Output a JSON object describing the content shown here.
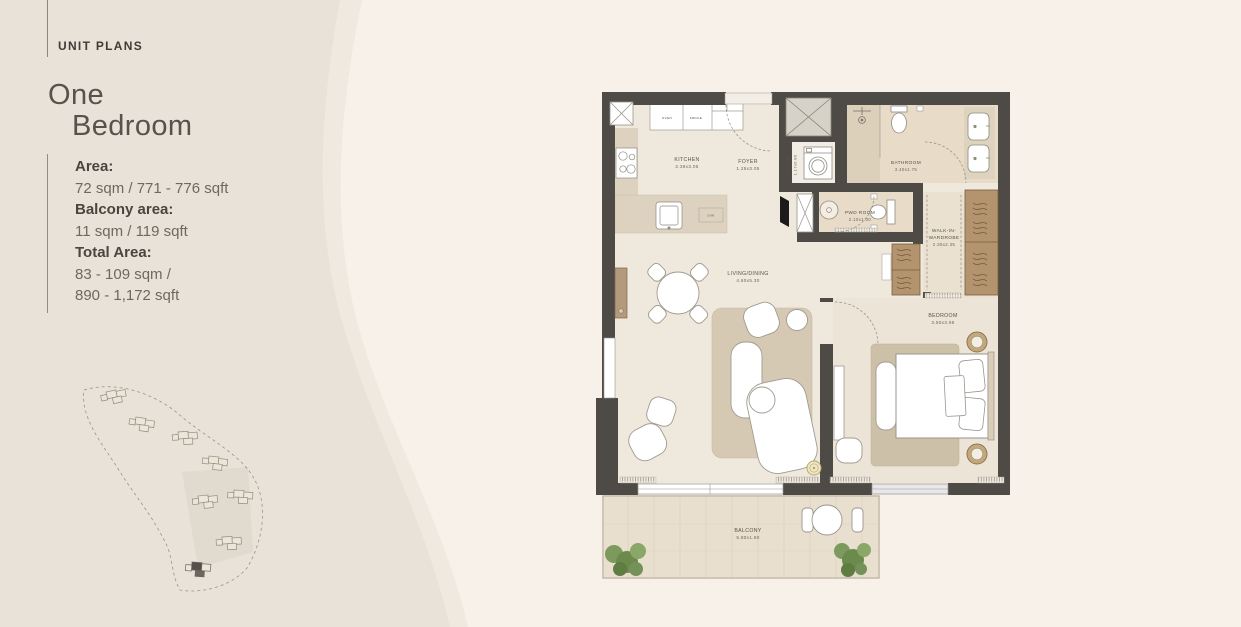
{
  "page": {
    "colors": {
      "background_left": "#e9e2d9",
      "background_swoosh": "#f7f1e9",
      "wall": "#4e4a46"
    }
  },
  "sidebar": {
    "eyebrow": "UNIT PLANS",
    "title_line1": "One",
    "title_line2": "Bedroom",
    "stats": [
      {
        "label": "Area:",
        "values": [
          "72 sqm / 771 - 776 sqft"
        ]
      },
      {
        "label": "Balcony area:",
        "values": [
          "11 sqm / 119 sqft"
        ]
      },
      {
        "label": "Total Area:",
        "values": [
          "83 - 109 sqm /",
          "890 - 1,172 sqft"
        ]
      }
    ]
  },
  "floorplan": {
    "rooms": {
      "kitchen": {
        "name": "KITCHEN",
        "dims": "2.39x3.05"
      },
      "foyer": {
        "name": "FOYER",
        "dims": "1.25x3.05"
      },
      "laundry": {
        "name": "LAUNDRY",
        "dims": "1.17x0.80"
      },
      "bathroom": {
        "name": "BATHROOM",
        "dims": "3.40x1.75"
      },
      "pwd": {
        "name": "PWD ROOM",
        "dims": "2.10x1.00"
      },
      "wardrobe": {
        "name_line1": "WALK-IN-",
        "name_line2": "WARDROBE",
        "dims": "2.30x2.35"
      },
      "living": {
        "name": "LIVING/DINING",
        "dims": "4.60x5.30"
      },
      "bedroom": {
        "name": "BEDROOM",
        "dims": "3.50x3.95"
      },
      "balcony": {
        "name": "BALCONY",
        "dims": "5.80x1.80"
      }
    },
    "appliances": {
      "oven": "OVEN",
      "fridge": "FRDGE",
      "dishwasher": "D/W"
    }
  }
}
